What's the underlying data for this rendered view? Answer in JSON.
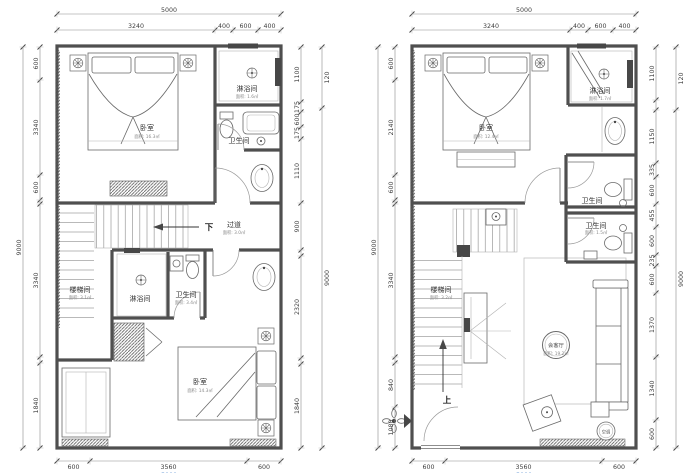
{
  "left_plan": {
    "dim_top_overall": "5000",
    "dim_top": [
      "3240",
      "400",
      "600",
      "400"
    ],
    "dim_left_overall": "9000",
    "dim_left": [
      "600",
      "3340",
      "600",
      "",
      "3340",
      "",
      "1840"
    ],
    "dim_right": [
      "1100",
      "175",
      "600",
      "175",
      "1110",
      "900",
      "",
      "2320",
      "",
      "1840"
    ],
    "dim_right_outer": [
      "120",
      "9000"
    ],
    "dim_bottom": [
      "600",
      "3560",
      "600"
    ],
    "dim_bottom_overall": "5000",
    "rooms": {
      "bedroom_top": {
        "name": "卧室",
        "area": "面积: 16.3㎡"
      },
      "shower_top": {
        "name": "淋浴间",
        "area": "面积: 1.6㎡"
      },
      "toilet_top": {
        "name": "卫生间"
      },
      "corridor": {
        "name": "过道",
        "area": "面积: 3.0㎡"
      },
      "down_label": "下",
      "stair": {
        "name": "楼梯间",
        "area": "面积: 3.1㎡"
      },
      "shower_mid": {
        "name": "淋浴间"
      },
      "toilet_mid": {
        "name": "卫生间",
        "area": "面积: 3.4㎡"
      },
      "bedroom_bottom": {
        "name": "卧室",
        "area": "面积: 14.3㎡"
      }
    }
  },
  "right_plan": {
    "dim_top_overall": "5000",
    "dim_top": [
      "3240",
      "400",
      "600",
      "400"
    ],
    "dim_left_overall": "9000",
    "dim_left": [
      "600",
      "2140",
      "600",
      "",
      "3340",
      "",
      "840",
      "1080"
    ],
    "dim_right": [
      "1100",
      "",
      "1150",
      "335",
      "600",
      "455",
      "600",
      "235",
      "600",
      "1370",
      "1340",
      "600"
    ],
    "dim_right_outer": [
      "120",
      "9000"
    ],
    "dim_bottom": [
      "600",
      "3560",
      "600"
    ],
    "dim_bottom_overall": "5000",
    "rooms": {
      "bedroom": {
        "name": "卧室",
        "area": "面积: 12.4㎡"
      },
      "shower": {
        "name": "淋浴间",
        "area": "面积: 1.7㎡"
      },
      "toilet_1": {
        "name": "卫生间",
        "area": "面积: 1.4㎡"
      },
      "toilet_2": {
        "name": "卫生间",
        "area": "面积: 1.5㎡"
      },
      "stair": {
        "name": "楼梯间",
        "area": "面积: 3.2㎡"
      },
      "living": {
        "name": "会客厅",
        "area": "面积: 19.2㎡"
      },
      "up_label": "上",
      "ac_badge": "空调"
    }
  }
}
